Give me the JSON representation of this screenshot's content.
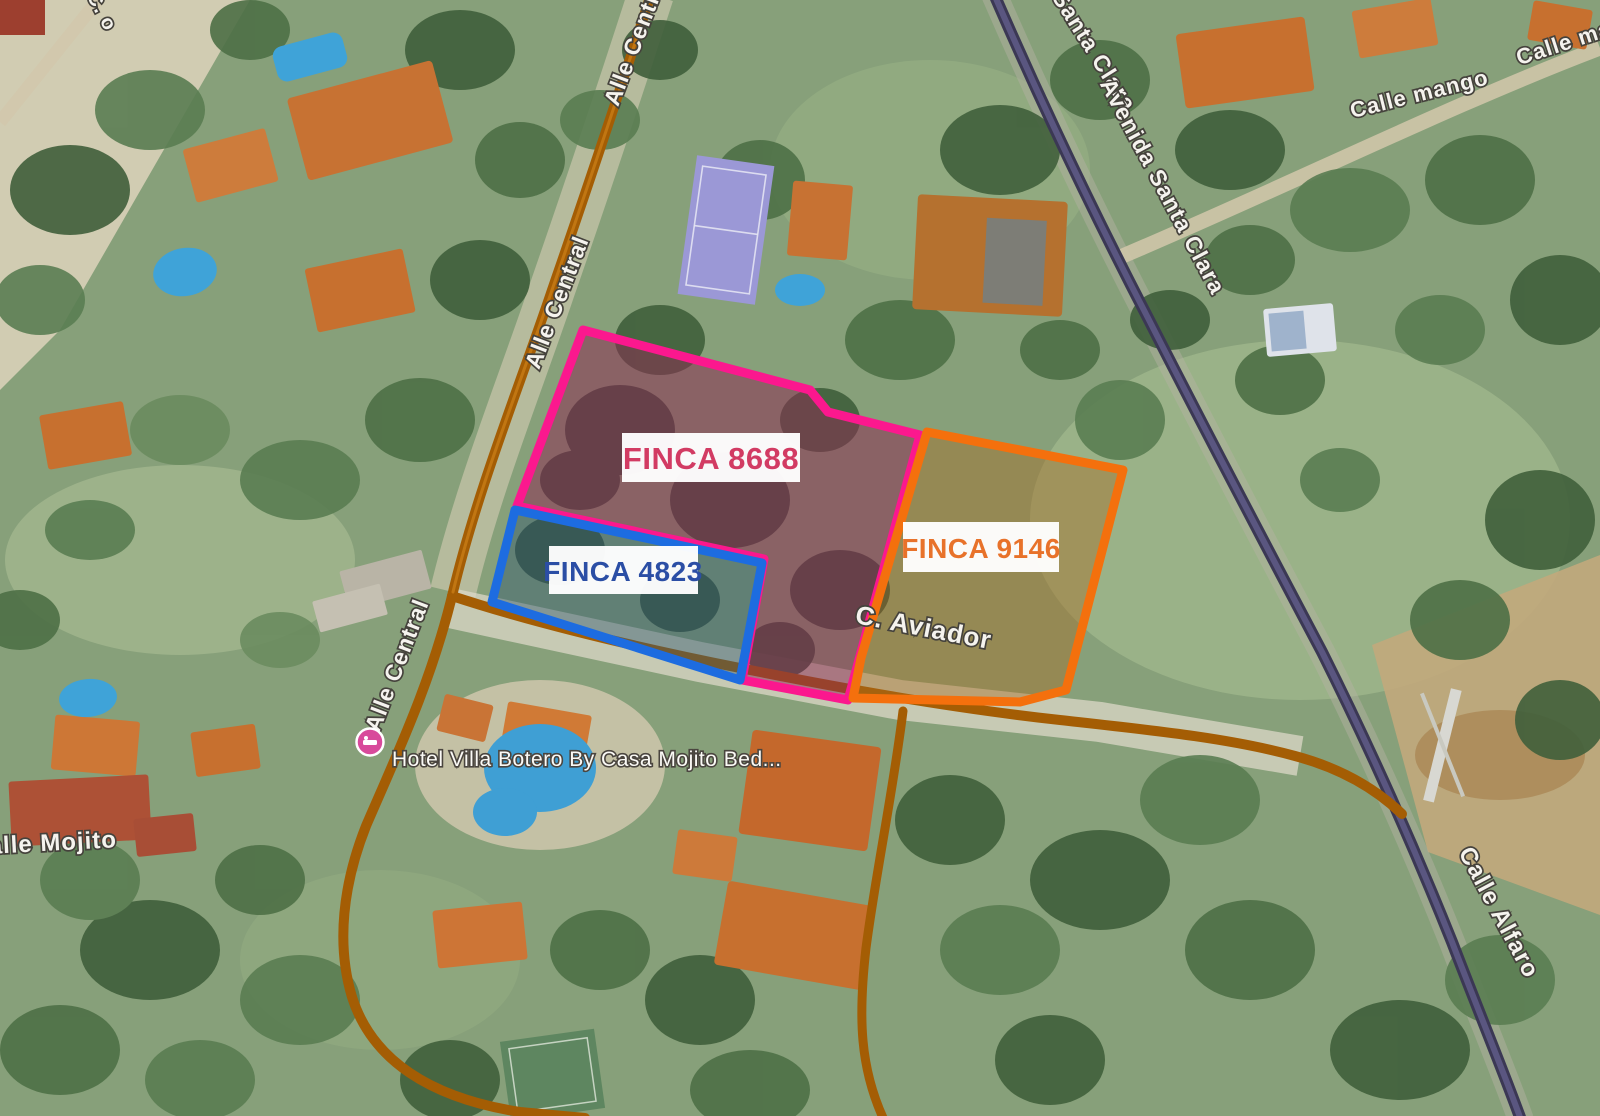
{
  "map": {
    "view_type": "satellite",
    "parcels": [
      {
        "name": "FINCA 8688",
        "outline_color": "#fb188e",
        "fill_color": "#8e2a52",
        "text_color": "#d23b63"
      },
      {
        "name": "FINCA 9146",
        "outline_color": "#f4700d",
        "fill_color": "#a96a1f",
        "text_color": "#e8722a"
      },
      {
        "name": "FINCA 4823",
        "outline_color": "#1d6ce0",
        "fill_color": "#33586e",
        "text_color": "#2b4ea5"
      }
    ],
    "street_labels": {
      "alle_central_top": "Alle Central",
      "alle_central_mid": "Alle Central",
      "alle_central_bottom": "Alle Central",
      "c_aviador": "C. Aviador",
      "avenida_santa_clara_partial": "a Santa Clara",
      "avenida_santa_clara": "Avenida Santa Clara",
      "calle_mango": "Calle mango",
      "calle_mango_2": "Calle ma",
      "calle_mojito": "Calle Mojito",
      "calle_alfaro": "Calle Alfaro",
      "partial_top_left": "C. o"
    },
    "poi": {
      "hotel_label": "Hotel Villa Botero By Casa Mojito Bed...",
      "icon": "bed-lodging-icon",
      "pin_color": "#d84a9b"
    },
    "road_colors": {
      "primary_road": "#a45d04",
      "secondary_road": "#514d72"
    }
  }
}
